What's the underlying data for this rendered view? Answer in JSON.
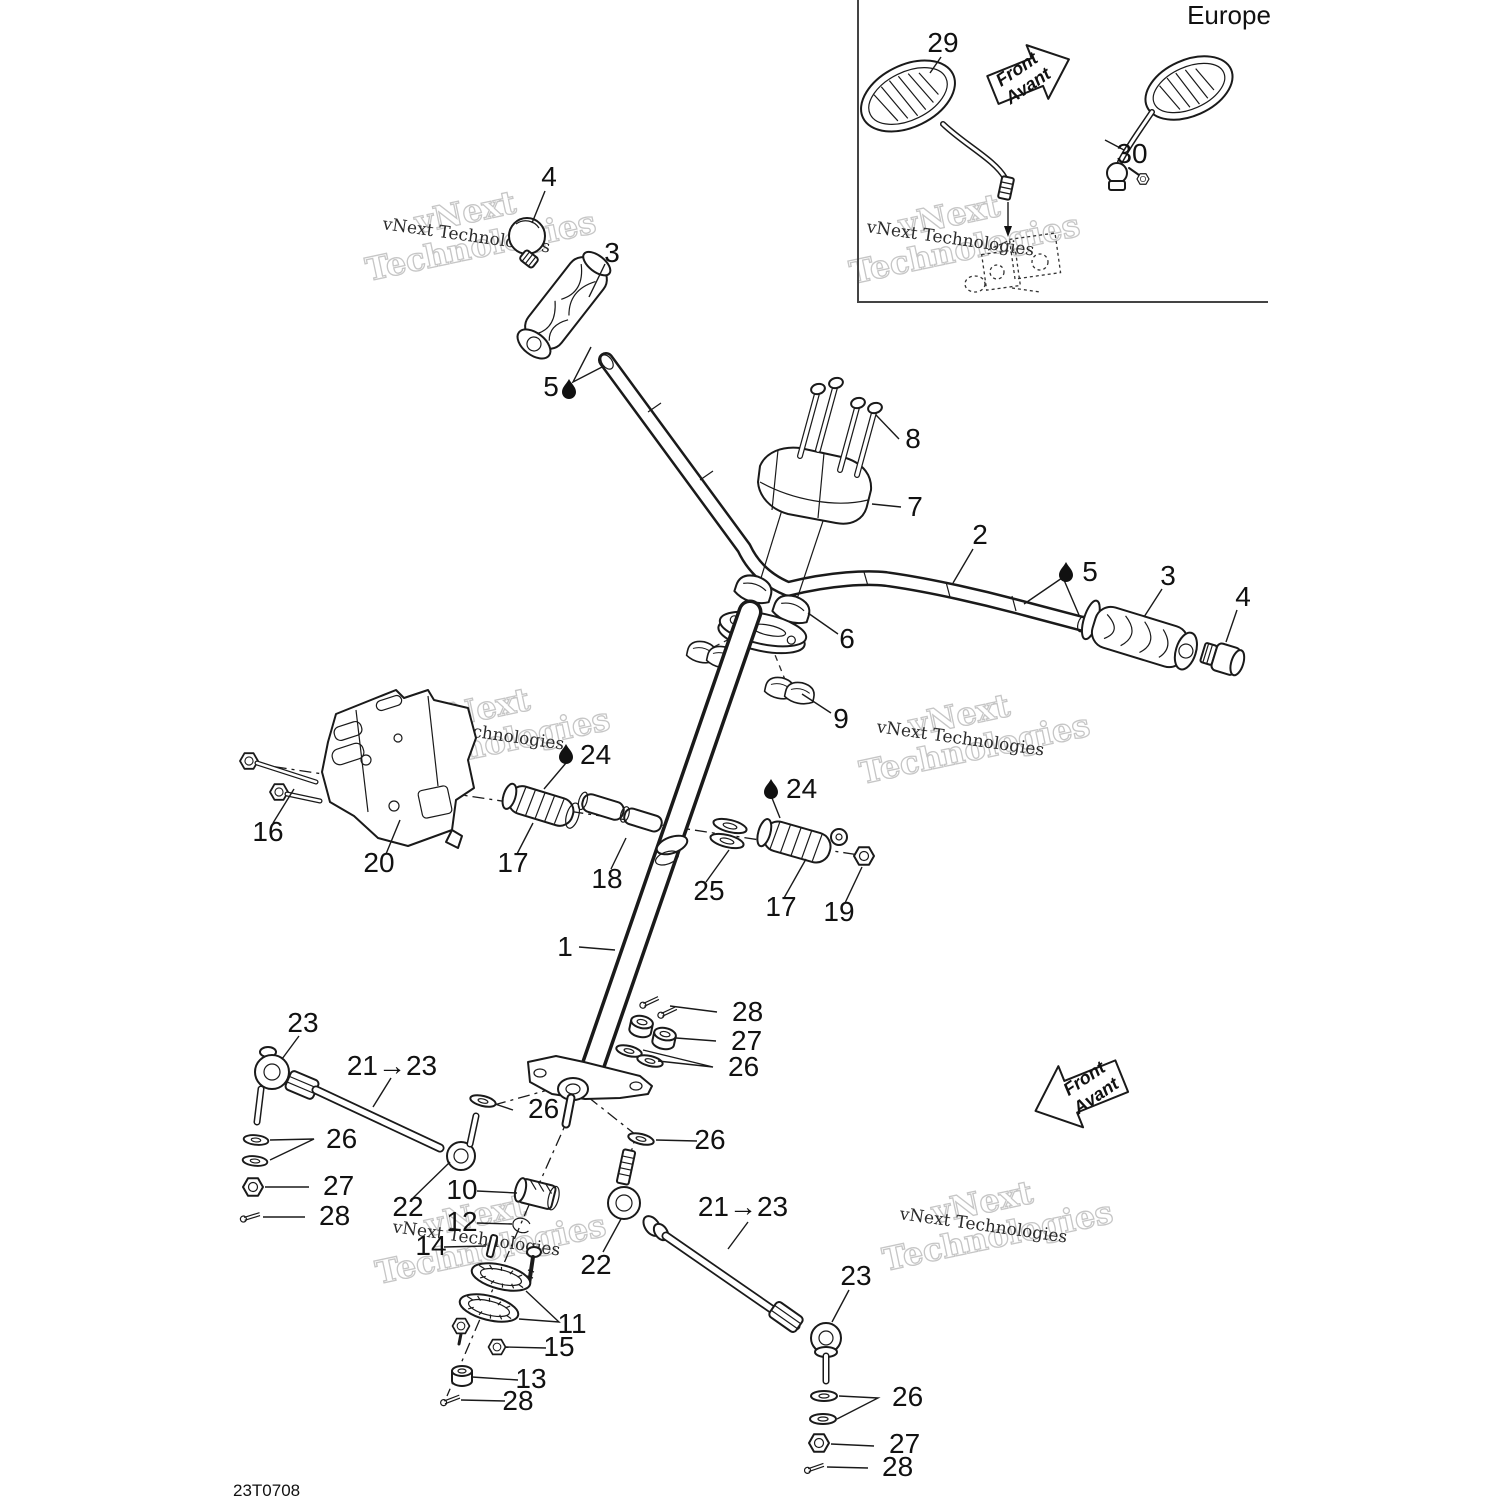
{
  "page": {
    "drawing_number": "23T0708",
    "background": "#ffffff",
    "line_color": "#1a1a1a"
  },
  "inset": {
    "region_label": "Europe",
    "front_arrow": {
      "line1": "Front",
      "line2": "Avant"
    }
  },
  "main_front_arrow": {
    "line1": "Front",
    "line2": "Avant"
  },
  "watermark": {
    "line1": "vNext",
    "line2": "Technologies",
    "full": "vNext Technologies"
  },
  "callouts": [
    {
      "id": "grip-cap-left",
      "label": "4"
    },
    {
      "id": "grip-left",
      "label": "3"
    },
    {
      "id": "grease-point-left",
      "label": "5"
    },
    {
      "id": "pad-bolts",
      "label": "8"
    },
    {
      "id": "handlebar-pad",
      "label": "7"
    },
    {
      "id": "handlebar",
      "label": "2"
    },
    {
      "id": "grease-point-right",
      "label": "5"
    },
    {
      "id": "grip-right",
      "label": "3"
    },
    {
      "id": "grip-cap-right",
      "label": "4"
    },
    {
      "id": "clamp-upper",
      "label": "6"
    },
    {
      "id": "clamp-caps",
      "label": "9"
    },
    {
      "id": "grease-clamp-left",
      "label": "24"
    },
    {
      "id": "bracket-bolts",
      "label": "16"
    },
    {
      "id": "support-bracket",
      "label": "20"
    },
    {
      "id": "clamp-half-left",
      "label": "17"
    },
    {
      "id": "bushings",
      "label": "18"
    },
    {
      "id": "thrust-washers",
      "label": "25"
    },
    {
      "id": "grease-clamp-right",
      "label": "24"
    },
    {
      "id": "clamp-half-right",
      "label": "17"
    },
    {
      "id": "clamp-nut",
      "label": "19"
    },
    {
      "id": "steering-column",
      "label": "1"
    },
    {
      "id": "cotter-pins-top",
      "label": "28"
    },
    {
      "id": "nuts-top",
      "label": "27"
    },
    {
      "id": "washers-top",
      "label": "26"
    },
    {
      "id": "washer-arm-left",
      "label": "26"
    },
    {
      "id": "washer-arm-right",
      "label": "26"
    },
    {
      "id": "tie-rod-end-left",
      "label": "23"
    },
    {
      "id": "tie-rod-range-left",
      "label": "21→23"
    },
    {
      "id": "washers-lower-left",
      "label": "26"
    },
    {
      "id": "nut-lower-left",
      "label": "27"
    },
    {
      "id": "cotter-lower-left",
      "label": "28"
    },
    {
      "id": "tie-rod-left",
      "label": "22"
    },
    {
      "id": "bearing",
      "label": "10"
    },
    {
      "id": "circlip",
      "label": "12"
    },
    {
      "id": "roll-pin",
      "label": "14"
    },
    {
      "id": "serrated-flanges",
      "label": "11"
    },
    {
      "id": "flange-nut",
      "label": "15"
    },
    {
      "id": "column-nut",
      "label": "13"
    },
    {
      "id": "cotter-center",
      "label": "28"
    },
    {
      "id": "tie-rod-right",
      "label": "22"
    },
    {
      "id": "tie-rod-range-right",
      "label": "21→23"
    },
    {
      "id": "tie-rod-end-right",
      "label": "23"
    },
    {
      "id": "washers-lower-right",
      "label": "26"
    },
    {
      "id": "nut-lower-right",
      "label": "27"
    },
    {
      "id": "cotter-lower-right",
      "label": "28"
    },
    {
      "id": "mirror-left",
      "label": "29"
    },
    {
      "id": "mirror-right",
      "label": "30"
    }
  ]
}
